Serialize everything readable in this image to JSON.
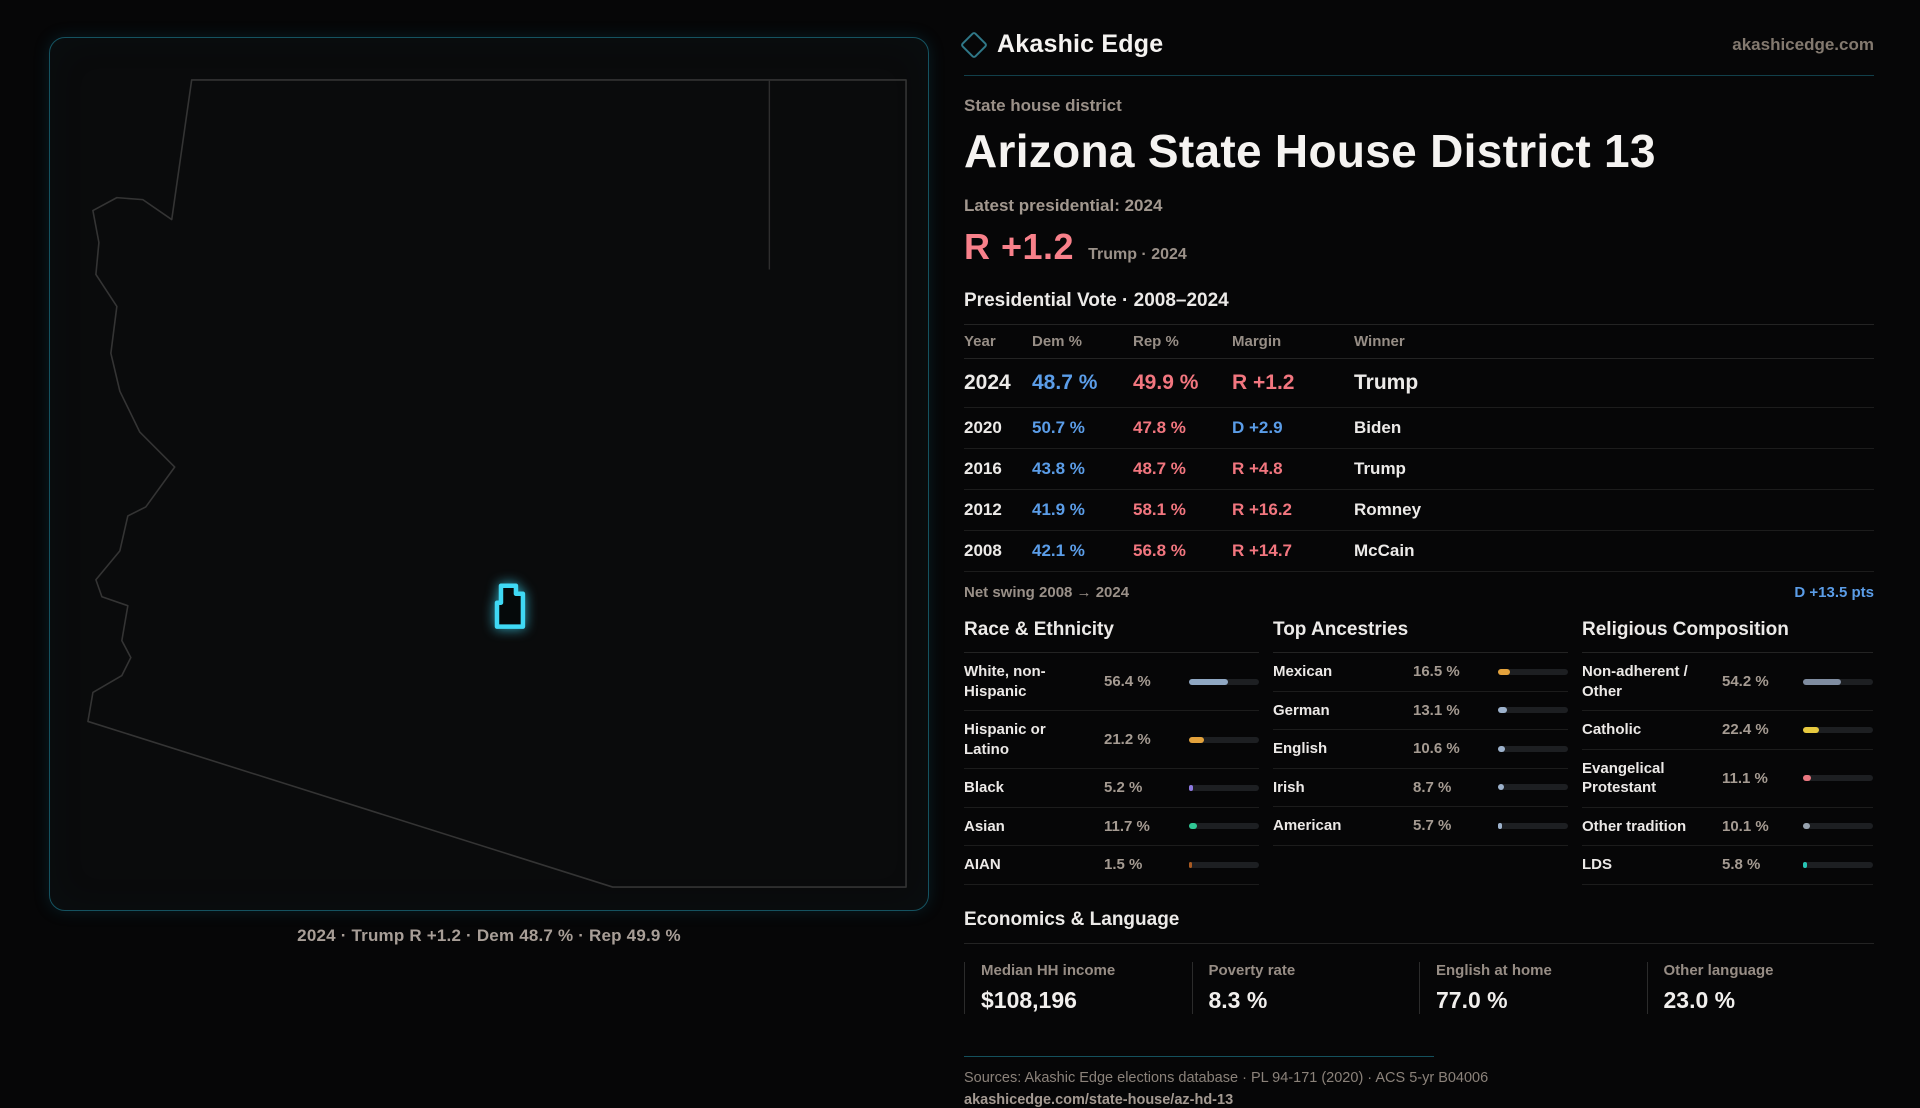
{
  "brand": {
    "name": "Akashic Edge",
    "site": "akashicedge.com"
  },
  "page": {
    "kicker": "State house district",
    "title": "Arizona State House District 13",
    "latest_label": "Latest presidential: 2024",
    "margin_big": "R +1.2",
    "margin_context": "Trump · 2024",
    "table_title": "Presidential Vote · 2008–2024"
  },
  "map": {
    "caption": "2024 · Trump R +1.2 · Dem 48.7 % · Rep 49.9 %"
  },
  "vote_table": {
    "columns": [
      "Year",
      "Dem %",
      "Rep %",
      "Margin",
      "Winner"
    ],
    "rows": [
      {
        "year": "2024",
        "dem": "48.7 %",
        "rep": "49.9 %",
        "margin": "R +1.2",
        "party": "R",
        "winner": "Trump"
      },
      {
        "year": "2020",
        "dem": "50.7 %",
        "rep": "47.8 %",
        "margin": "D +2.9",
        "party": "D",
        "winner": "Biden"
      },
      {
        "year": "2016",
        "dem": "43.8 %",
        "rep": "48.7 %",
        "margin": "R +4.8",
        "party": "R",
        "winner": "Trump"
      },
      {
        "year": "2012",
        "dem": "41.9 %",
        "rep": "58.1 %",
        "margin": "R +16.2",
        "party": "R",
        "winner": "Romney"
      },
      {
        "year": "2008",
        "dem": "42.1 %",
        "rep": "56.8 %",
        "margin": "R +14.7",
        "party": "R",
        "winner": "McCain"
      }
    ]
  },
  "net_swing": {
    "label": "Net swing 2008 → 2024",
    "value": "D +13.5 pts"
  },
  "demographics": [
    {
      "title": "Race & Ethnicity",
      "items": [
        {
          "label": "White, non-Hispanic",
          "value": "56.4 %",
          "pct": 56.4,
          "color": "#8fa7c2"
        },
        {
          "label": "Hispanic or Latino",
          "value": "21.2 %",
          "pct": 21.2,
          "color": "#e3a23c"
        },
        {
          "label": "Black",
          "value": "5.2 %",
          "pct": 5.2,
          "color": "#8d79e0"
        },
        {
          "label": "Asian",
          "value": "11.7 %",
          "pct": 11.7,
          "color": "#30c795"
        },
        {
          "label": "AIAN",
          "value": "1.5 %",
          "pct": 1.5,
          "color": "#a85a22"
        }
      ]
    },
    {
      "title": "Top Ancestries",
      "items": [
        {
          "label": "Mexican",
          "value": "16.5 %",
          "pct": 16.5,
          "color": "#e3a23c"
        },
        {
          "label": "German",
          "value": "13.1 %",
          "pct": 13.1,
          "color": "#9db2cc"
        },
        {
          "label": "English",
          "value": "10.6 %",
          "pct": 10.6,
          "color": "#9db2cc"
        },
        {
          "label": "Irish",
          "value": "8.7 %",
          "pct": 8.7,
          "color": "#9db2cc"
        },
        {
          "label": "American",
          "value": "5.7 %",
          "pct": 5.7,
          "color": "#9db2cc"
        }
      ]
    },
    {
      "title": "Religious Composition",
      "items": [
        {
          "label": "Non-adherent / Other",
          "value": "54.2 %",
          "pct": 54.2,
          "color": "#7f8ca0"
        },
        {
          "label": "Catholic",
          "value": "22.4 %",
          "pct": 22.4,
          "color": "#e7c93f"
        },
        {
          "label": "Evangelical Protestant",
          "value": "11.1 %",
          "pct": 11.1,
          "color": "#e8767f"
        },
        {
          "label": "Other tradition",
          "value": "10.1 %",
          "pct": 10.1,
          "color": "#97a2ae"
        },
        {
          "label": "LDS",
          "value": "5.8 %",
          "pct": 5.8,
          "color": "#27c4b4"
        }
      ]
    }
  ],
  "economics": {
    "title": "Economics & Language",
    "stats": [
      {
        "label": "Median HH income",
        "value": "$108,196"
      },
      {
        "label": "Poverty rate",
        "value": "8.3 %"
      },
      {
        "label": "English at home",
        "value": "77.0 %"
      },
      {
        "label": "Other language",
        "value": "23.0 %"
      }
    ]
  },
  "footer": {
    "sources": "Sources: Akashic Edge elections database · PL 94-171 (2020) · ACS 5-yr B04006",
    "permalink": "akashicedge.com/state-house/az-hd-13"
  },
  "colors": {
    "dem": "#5b9de8",
    "rep": "#f2767f",
    "accent": "#3fd9f5"
  }
}
